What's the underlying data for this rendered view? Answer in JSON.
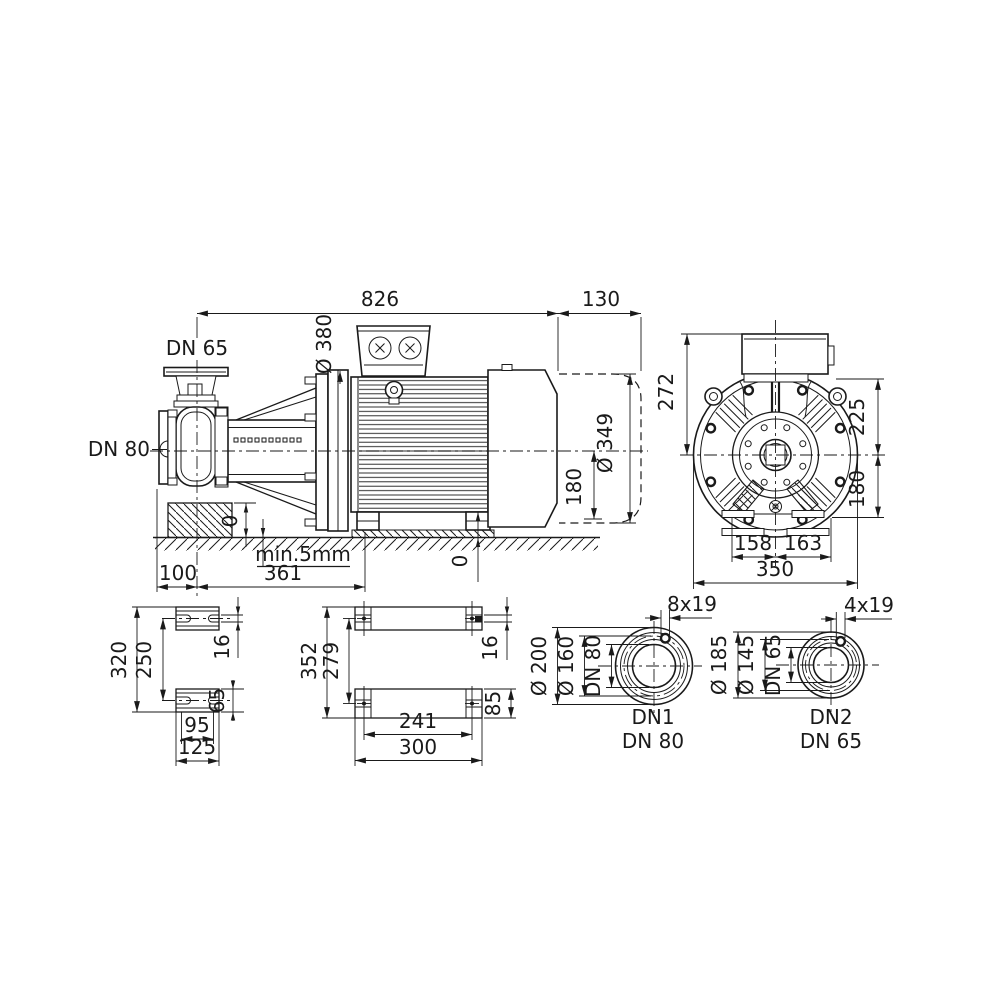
{
  "colors": {
    "line": "#1a1a1a",
    "background": "#ffffff"
  },
  "drawing": {
    "type": "pump_dimensional_drawing",
    "side_view": {
      "dim_total": "826",
      "dim_overhang": "130",
      "dim_flange_dia": "Ø 380",
      "label_discharge": "DN 65",
      "label_suction": "DN 80",
      "dim_motor_dia": "Ø 349",
      "dim_axis_height": "180",
      "dim_zero_pedestal": "0",
      "dim_zero_foot": "0",
      "note_grout": "min.5mm",
      "dim_suction_offset": "100",
      "dim_base_length": "361"
    },
    "end_view": {
      "dim_272": "272",
      "dim_225": "225",
      "dim_180": "180",
      "dim_158": "158",
      "dim_163": "163",
      "dim_350": "350"
    },
    "pump_foot_view": {
      "dim_320": "320",
      "dim_250": "250",
      "dim_16": "16",
      "dim_65": "65",
      "dim_95": "95",
      "dim_125": "125"
    },
    "motor_foot_view": {
      "dim_352": "352",
      "dim_279": "279",
      "dim_16": "16",
      "dim_85": "85",
      "dim_241": "241",
      "dim_300": "300"
    },
    "flange_dn1": {
      "dim_holes": "8x19",
      "dim_outer": "Ø 200",
      "dim_bolt_circle": "Ø 160",
      "dim_bore": "DN 80",
      "caption": "DN1",
      "caption_size": "DN 80"
    },
    "flange_dn2": {
      "dim_holes": "4x19",
      "dim_outer": "Ø 185",
      "dim_bolt_circle": "Ø 145",
      "dim_bore": "DN 65",
      "caption": "DN2",
      "caption_size": "DN 65"
    }
  }
}
